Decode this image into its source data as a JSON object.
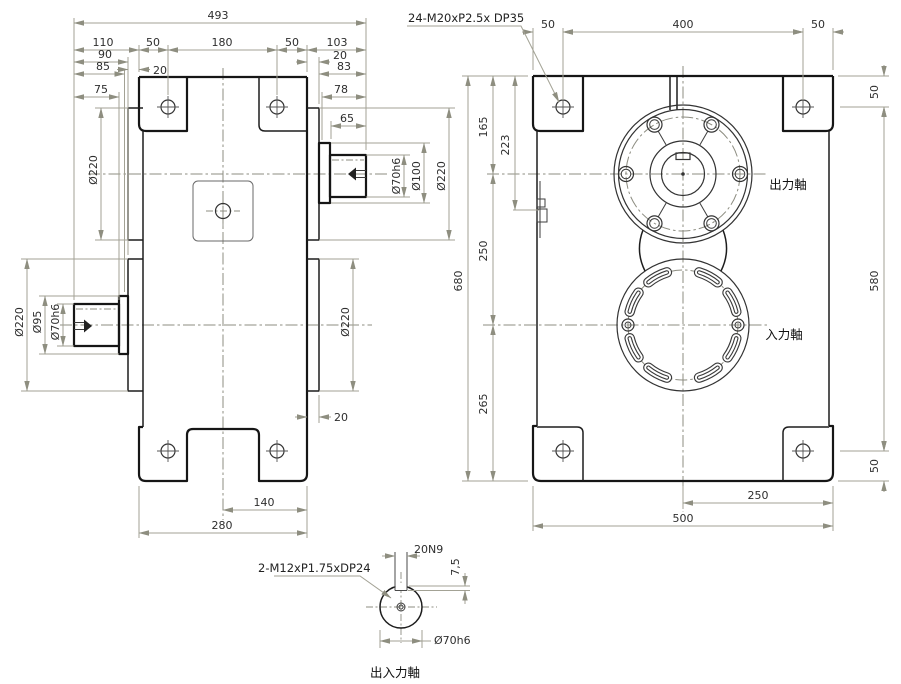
{
  "side_view": {
    "dims": {
      "overall_length": "493",
      "rear_ext": "110",
      "tab_front": "50",
      "bolt_span": "180",
      "tab_rear": "50",
      "front_ext": "103",
      "d90": "90",
      "d85": "85",
      "d75": "75",
      "tab_offset": "20",
      "boss_step_top": "20",
      "d83": "83",
      "d78": "78",
      "shaft_len": "65",
      "boss_step_mid": "20",
      "foot_half": "140",
      "depth": "280",
      "boss_dia_left_top": "Ø220",
      "boss_dia_left_bottom": "Ø220",
      "collar_dia_in": "Ø95",
      "shaft_dia_in": "Ø70h6",
      "shaft_dia_out": "Ø70h6",
      "collar_dia_out": "Ø100",
      "boss_dia_right_top": "Ø220",
      "boss_dia_right_bottom": "Ø220"
    }
  },
  "front_view": {
    "thread_note": "24-M20xP2.5x DP35",
    "dims": {
      "edge_left": "50",
      "bolt_span_h": "400",
      "edge_right": "50",
      "edge_top": "50",
      "bolt_span_v": "580",
      "edge_bottom": "50",
      "height": "680",
      "out_axis": "165",
      "gauge": "223",
      "axis_gap": "250",
      "in_axis_bottom": "265",
      "half_width": "250",
      "width": "500"
    },
    "labels": {
      "output_shaft": "出力軸",
      "input_shaft": "入力軸"
    }
  },
  "detail_view": {
    "thread_note": "2-M12xP1.75xDP24",
    "dims": {
      "key_width": "20N9",
      "key_depth": "7,5",
      "shaft_dia": "Ø70h6"
    },
    "caption": "出入力軸"
  },
  "colors": {
    "line": "#1a1a1a",
    "dim_line": "#a3a295",
    "centerline": "#8c8c80",
    "text": "#2e2e2e",
    "background": "#ffffff"
  }
}
